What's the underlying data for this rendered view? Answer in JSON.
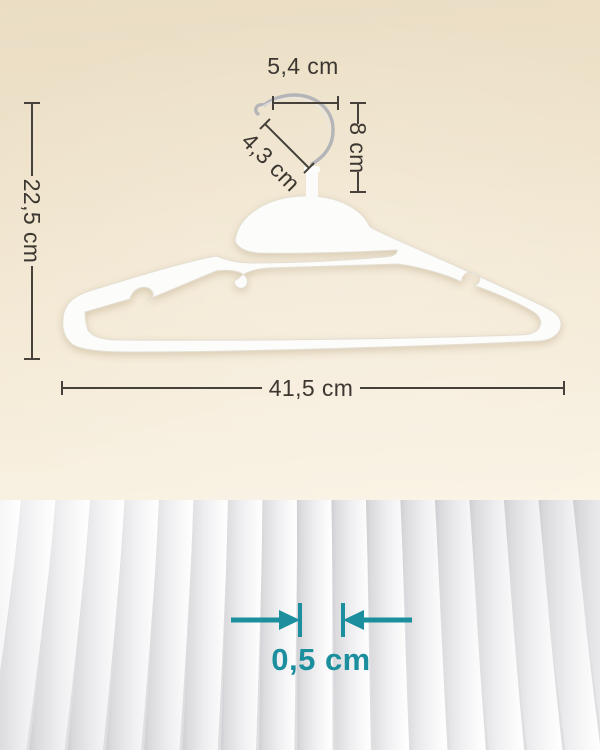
{
  "measurements": {
    "hook_width": "5,4 cm",
    "hook_opening_diameter": "4,3 cm",
    "hook_height": "8 cm",
    "hanger_height": "22,5 cm",
    "hanger_width": "41,5 cm",
    "hanger_thickness": "0,5 cm"
  },
  "colors": {
    "accent_teal": "#1B8F9D",
    "dimension_ink": "#46423B",
    "hanger_white": "#FCFCFA",
    "background_beige": "#F0E4CD"
  },
  "scene": {
    "top_panel": "white s-shape hanger with swivel metal hook and dimension lines",
    "bottom_panel": "close-up of stacked hanger edges showing thickness"
  }
}
